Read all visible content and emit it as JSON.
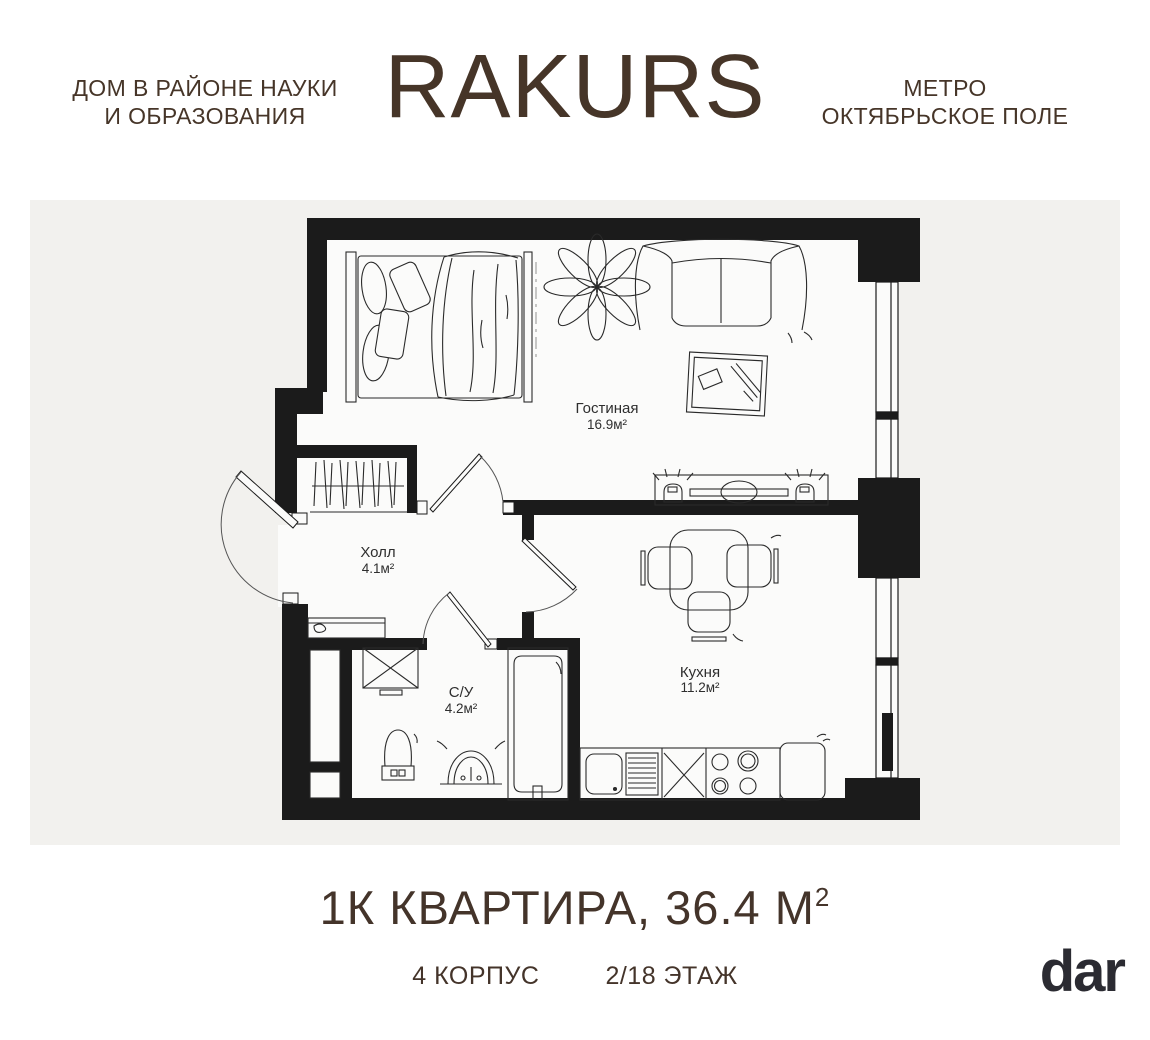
{
  "header": {
    "tagline": [
      "ДОМ В РАЙОНЕ НАУКИ",
      "И ОБРАЗОВАНИЯ"
    ],
    "logo": "RAKURS",
    "metro": [
      "МЕТРО",
      "ОКТЯБРЬСКОЕ ПОЛЕ"
    ]
  },
  "plan": {
    "rooms": [
      {
        "name": "Гостиная",
        "area": "16.9м²"
      },
      {
        "name": "Холл",
        "area": "4.1м²"
      },
      {
        "name": "С/У",
        "area": "4.2м²"
      },
      {
        "name": "Кухня",
        "area": "11.2м²"
      }
    ]
  },
  "footer": {
    "title": "1К КВАРТИРА, 36.4 М",
    "title_sup": "2",
    "building": "4 КОРПУС",
    "floor": "2/18 ЭТАЖ",
    "brand": "dar"
  },
  "colors": {
    "brown": "#463528",
    "panel_bg": "#f2f1ee",
    "wall": "#1b1b1b",
    "interior": "#fbfbfa",
    "brand_dark": "#2b2b32"
  }
}
